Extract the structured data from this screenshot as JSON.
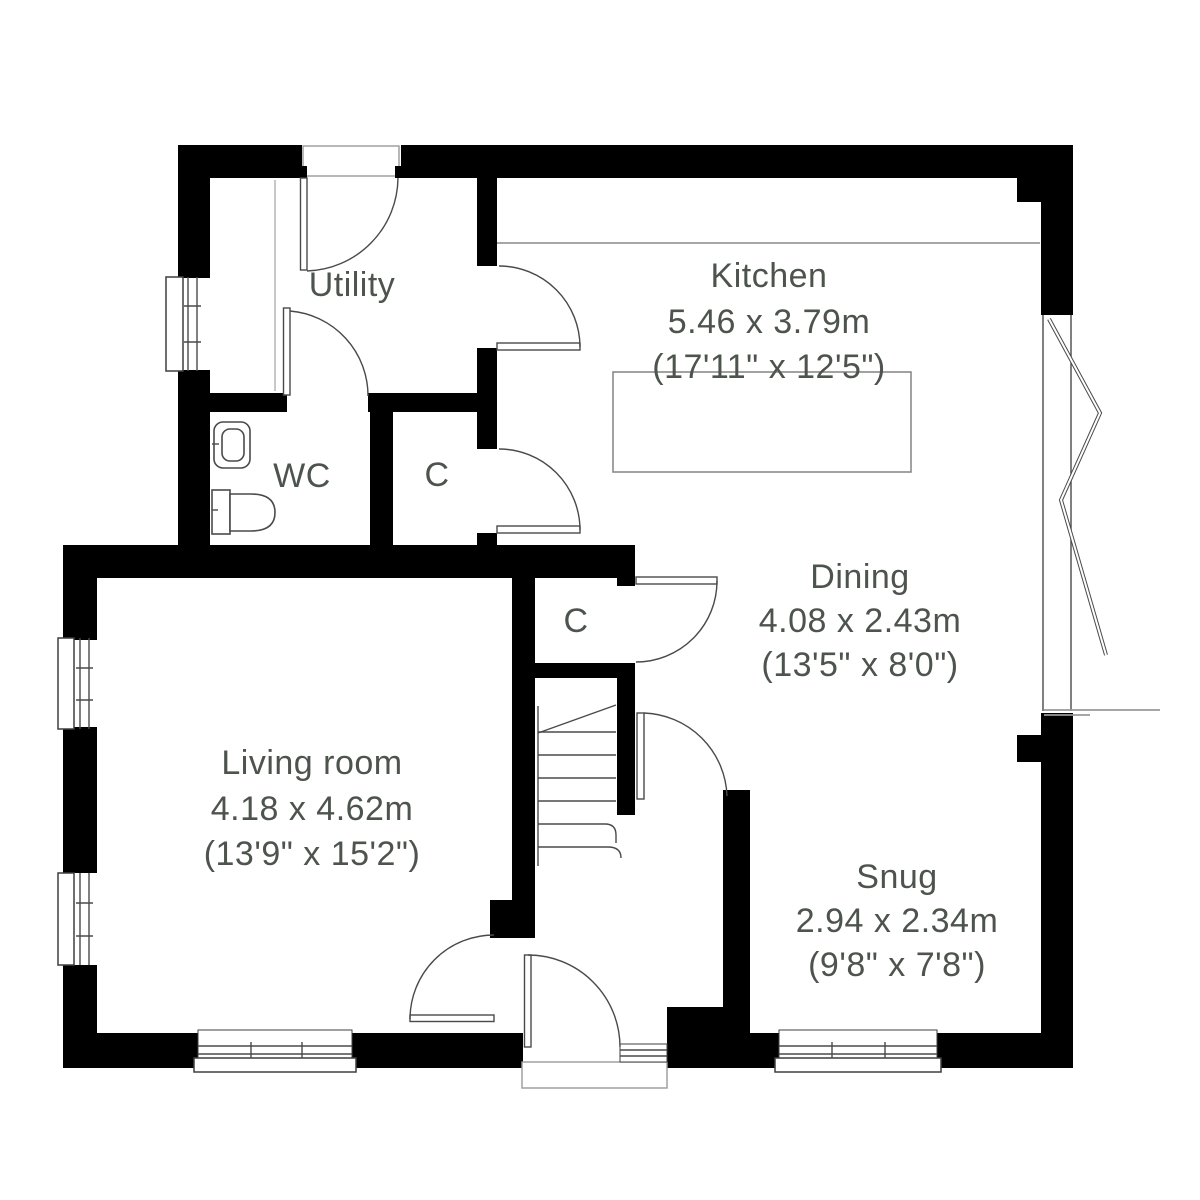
{
  "plan": {
    "rooms": {
      "utility": {
        "label": "Utility"
      },
      "kitchen": {
        "label": "Kitchen",
        "size_metric": "5.46 x 3.79m",
        "size_imperial": "(17'11\" x 12'5\")"
      },
      "wc": {
        "label": "WC"
      },
      "kitchen_cupboard": {
        "label": "C"
      },
      "hall_cupboard": {
        "label": "C"
      },
      "dining": {
        "label": "Dining",
        "size_metric": "4.08 x 2.43m",
        "size_imperial": "(13'5\" x 8'0\")"
      },
      "living_room": {
        "label": "Living room",
        "size_metric": "4.18 x 4.62m",
        "size_imperial": "(13'9\" x 15'2\")"
      },
      "snug": {
        "label": "Snug",
        "size_metric": "2.94 x 2.34m",
        "size_imperial": "(9'8\" x 7'8\")"
      }
    },
    "colors": {
      "wall": "#000000",
      "text": "#4d534d",
      "line": "#4a4a4a",
      "light_line": "#999999",
      "background": "#ffffff"
    }
  }
}
